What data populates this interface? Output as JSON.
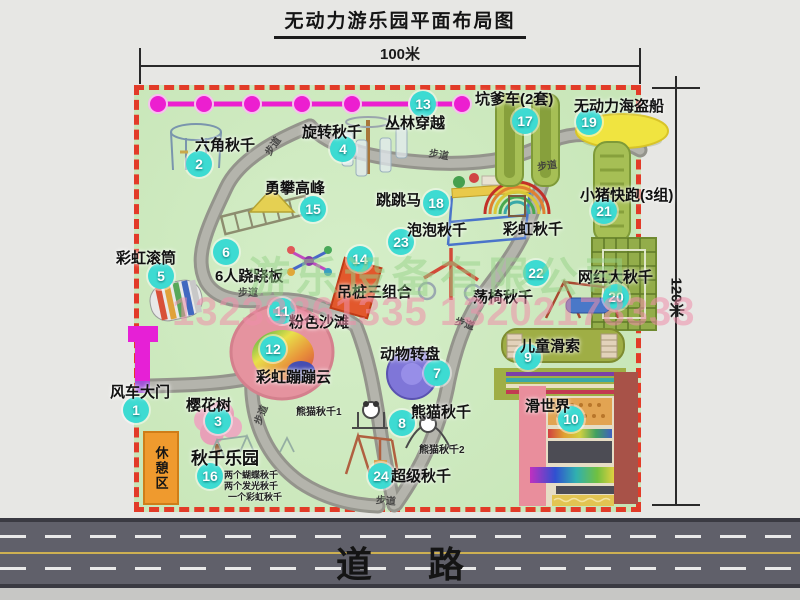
{
  "title": "无动力游乐园平面布局图",
  "dimensions": {
    "width": "100米",
    "height": "120米"
  },
  "road": {
    "label": "道路"
  },
  "rest_area": {
    "label": "休憩区"
  },
  "watermark": {
    "company": "游乐设备有限公司",
    "phone": "13233861335 13202178333"
  },
  "colors": {
    "map_background": "#cbe7bd",
    "boundary_dashed": "#e23b28",
    "badge": "#3ddbd2",
    "jungle_chain": "#ec1fd0",
    "gate": "#e620d6",
    "rest_area": "#ef9a2e",
    "road": "#60606a",
    "road_centerline": "#cdb052"
  },
  "map": {
    "path_label": "步道",
    "path_labels": [
      {
        "x": 429,
        "y": 146,
        "r": 10
      },
      {
        "x": 537,
        "y": 157,
        "r": -8
      },
      {
        "x": 238,
        "y": 284,
        "r": 0
      },
      {
        "x": 262,
        "y": 138,
        "r": -55
      },
      {
        "x": 250,
        "y": 407,
        "r": -68
      },
      {
        "x": 376,
        "y": 492,
        "r": 5
      },
      {
        "x": 455,
        "y": 315,
        "r": 18
      }
    ],
    "attractions": [
      {
        "num": 1,
        "name": "风车大门",
        "badge": {
          "x": 136,
          "y": 410
        },
        "label": {
          "x": 110,
          "y": 381
        }
      },
      {
        "num": 2,
        "name": "六角秋千",
        "badge": {
          "x": 199,
          "y": 164
        },
        "label": {
          "x": 195,
          "y": 134
        }
      },
      {
        "num": 3,
        "name": "樱花树",
        "badge": {
          "x": 218,
          "y": 421
        },
        "label": {
          "x": 186,
          "y": 394
        }
      },
      {
        "num": 4,
        "name": "旋转秋千",
        "badge": {
          "x": 343,
          "y": 149
        },
        "label": {
          "x": 302,
          "y": 121
        }
      },
      {
        "num": 5,
        "name": "彩虹滚筒",
        "badge": {
          "x": 161,
          "y": 276
        },
        "label": {
          "x": 116,
          "y": 247
        }
      },
      {
        "num": 6,
        "name": "6人跷跷板",
        "badge": {
          "x": 226,
          "y": 252
        },
        "label": {
          "x": 215,
          "y": 265
        }
      },
      {
        "num": 7,
        "name": "动物转盘",
        "badge": {
          "x": 437,
          "y": 373
        },
        "label": {
          "x": 380,
          "y": 343
        }
      },
      {
        "num": 8,
        "name": "熊猫秋千",
        "badge": {
          "x": 402,
          "y": 423
        },
        "label": {
          "x": 411,
          "y": 401
        }
      },
      {
        "num": 9,
        "name": "儿童滑索",
        "badge": {
          "x": 528,
          "y": 357
        },
        "label": {
          "x": 520,
          "y": 335
        }
      },
      {
        "num": 10,
        "name": "滑世界",
        "badge": {
          "x": 571,
          "y": 419
        },
        "label": {
          "x": 525,
          "y": 395
        }
      },
      {
        "num": 11,
        "name": "粉色沙滩",
        "badge": {
          "x": 282,
          "y": 311
        },
        "label": {
          "x": 289,
          "y": 311
        }
      },
      {
        "num": 12,
        "name": "彩虹蹦蹦云",
        "badge": {
          "x": 273,
          "y": 349
        },
        "label": {
          "x": 256,
          "y": 366
        }
      },
      {
        "num": 13,
        "name": "丛林穿越",
        "badge": {
          "x": 423,
          "y": 104
        },
        "label": {
          "x": 385,
          "y": 112
        }
      },
      {
        "num": 14,
        "name": "吊桩三组合",
        "badge": {
          "x": 360,
          "y": 259
        },
        "label": {
          "x": 337,
          "y": 281
        }
      },
      {
        "num": 15,
        "name": "勇攀高峰",
        "badge": {
          "x": 313,
          "y": 209
        },
        "label": {
          "x": 265,
          "y": 177
        }
      },
      {
        "num": 16,
        "name": "秋千乐园",
        "badge": {
          "x": 210,
          "y": 476
        },
        "label": {
          "x": 191,
          "y": 444,
          "size": 17
        }
      },
      {
        "num": 17,
        "name": "坑爹车(2套)",
        "badge": {
          "x": 525,
          "y": 121
        },
        "label": {
          "x": 475,
          "y": 88
        }
      },
      {
        "num": 18,
        "name": "跳跳马",
        "badge": {
          "x": 436,
          "y": 203
        },
        "label": {
          "x": 376,
          "y": 189
        }
      },
      {
        "num": 19,
        "name": "无动力海盗船",
        "badge": {
          "x": 589,
          "y": 122
        },
        "label": {
          "x": 574,
          "y": 95
        }
      },
      {
        "num": 20,
        "name": "网红大秋千",
        "badge": {
          "x": 616,
          "y": 297
        },
        "label": {
          "x": 578,
          "y": 266
        }
      },
      {
        "num": 21,
        "name": "小猪快跑(3组)",
        "badge": {
          "x": 604,
          "y": 211
        },
        "label": {
          "x": 580,
          "y": 184
        }
      },
      {
        "num": 22,
        "name": "荡椅秋千",
        "badge": {
          "x": 536,
          "y": 273
        },
        "label": {
          "x": 473,
          "y": 286
        }
      },
      {
        "num": 23,
        "name": "泡泡秋千",
        "badge": {
          "x": 401,
          "y": 242
        },
        "label": {
          "x": 407,
          "y": 219
        }
      },
      {
        "num": 24,
        "name": "超级秋千",
        "badge": {
          "x": 381,
          "y": 476
        },
        "label": {
          "x": 391,
          "y": 465
        }
      },
      {
        "num": null,
        "name": "彩虹秋千",
        "badge": null,
        "label": {
          "x": 503,
          "y": 218
        }
      }
    ],
    "small_labels": [
      {
        "text": "熊猫秋千1",
        "x": 296,
        "y": 403
      },
      {
        "text": "熊猫秋千2",
        "x": 419,
        "y": 441
      },
      {
        "text": "两个蝴蝶秋千",
        "x": 224,
        "y": 468,
        "size": 9
      },
      {
        "text": "两个发光秋千",
        "x": 224,
        "y": 479,
        "size": 9
      },
      {
        "text": "一个彩虹秋千",
        "x": 228,
        "y": 490,
        "size": 9
      }
    ]
  }
}
